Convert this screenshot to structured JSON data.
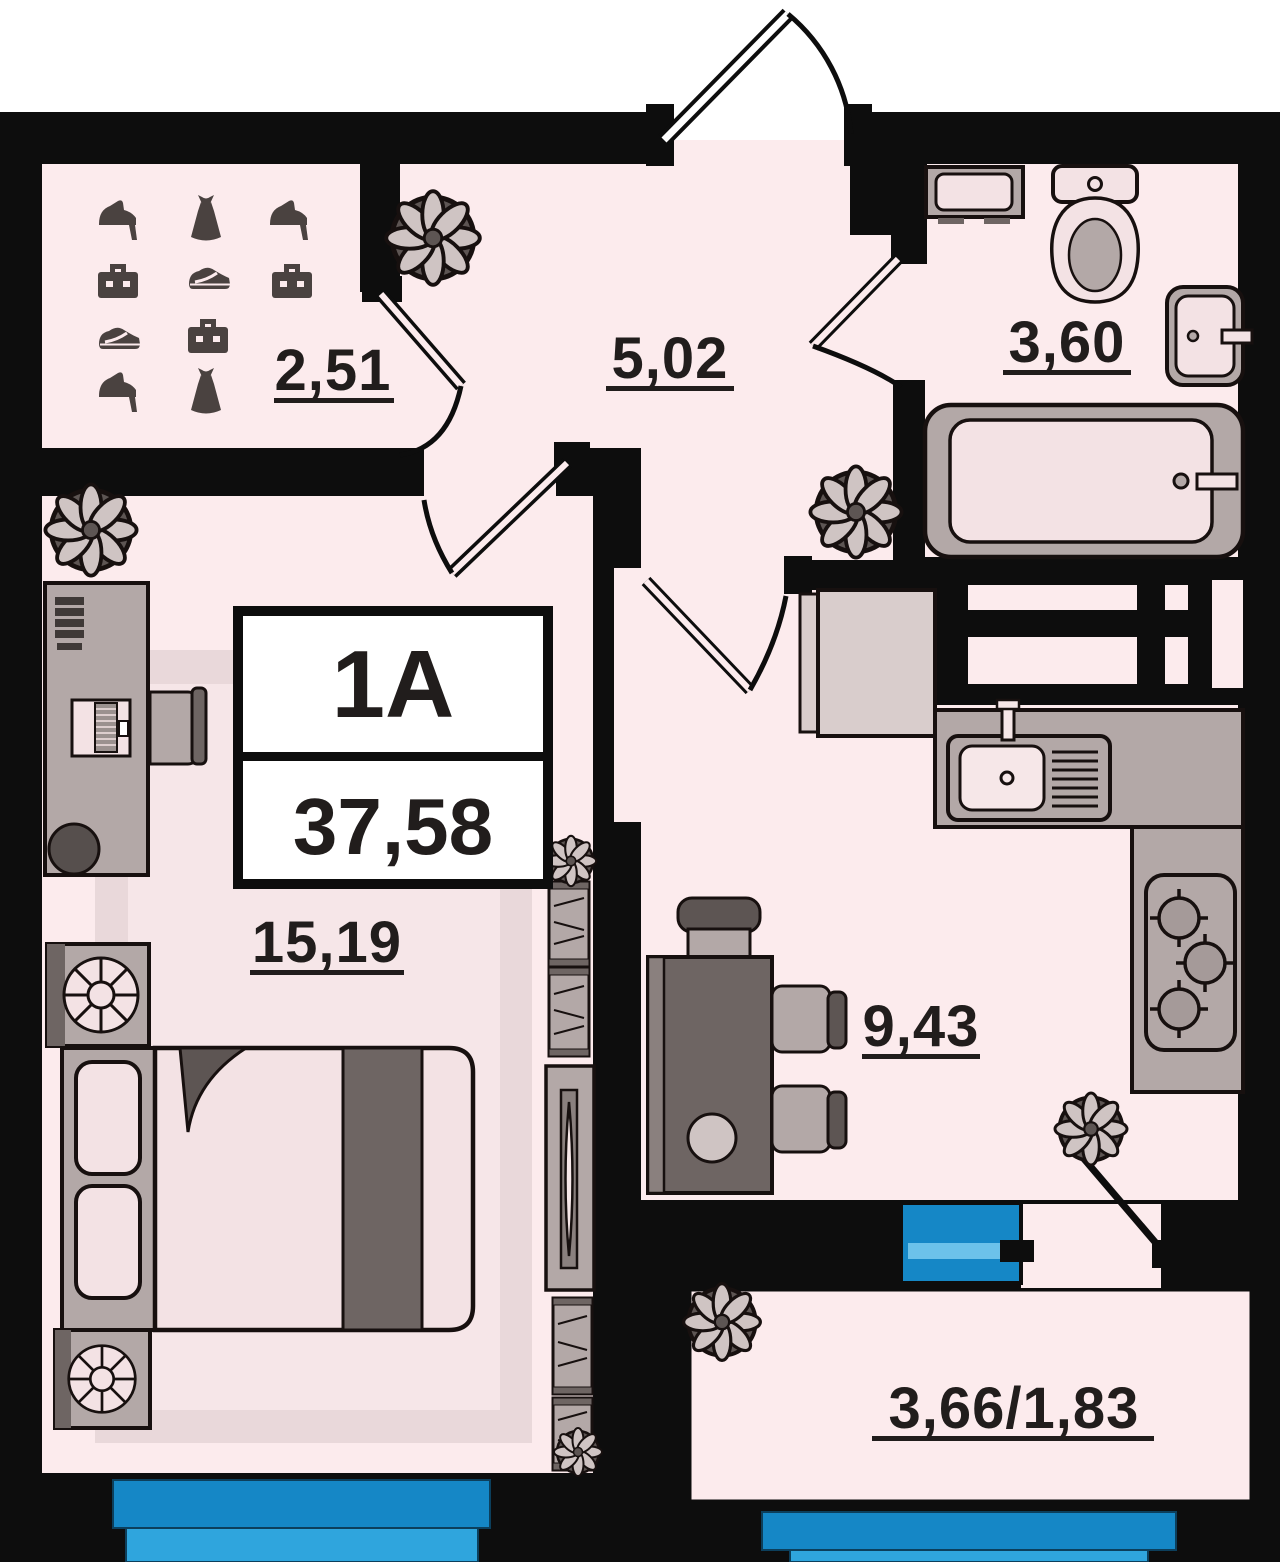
{
  "plan": {
    "unit": {
      "type_label": "1А",
      "total_area": "37,58"
    },
    "rooms": [
      {
        "id": "wardrobe",
        "area": "2,51"
      },
      {
        "id": "hallway",
        "area": "5,02"
      },
      {
        "id": "bathroom",
        "area": "3,60"
      },
      {
        "id": "living-room",
        "area": "15,19"
      },
      {
        "id": "kitchen",
        "area": "9,43"
      },
      {
        "id": "balcony",
        "area": "3,66/1,83"
      }
    ],
    "colors": {
      "wall": "#0d0d0d",
      "floor": "#fcebed",
      "carpet": "#e9d8da",
      "carpet_inner": "#f6e6e8",
      "furniture": "#b3a8a7",
      "furniture_light": "#f3e2e4",
      "furniture_dark": "#6e6563",
      "window_blue": "#1587c6",
      "window_blue_light": "#2fa5dd",
      "icon_dark": "#4a4240"
    },
    "icons": [
      "high-heel-icon",
      "dress-icon",
      "briefcase-icon",
      "sneaker-icon",
      "plant-icon",
      "bed",
      "pillow",
      "pouf",
      "desk",
      "computer",
      "office-chair",
      "shelf",
      "tv",
      "washing-machine",
      "toilet",
      "wash-basin",
      "bathtub",
      "kitchen-sink",
      "stove",
      "fridge",
      "dining-table",
      "chair",
      "window",
      "door"
    ]
  }
}
